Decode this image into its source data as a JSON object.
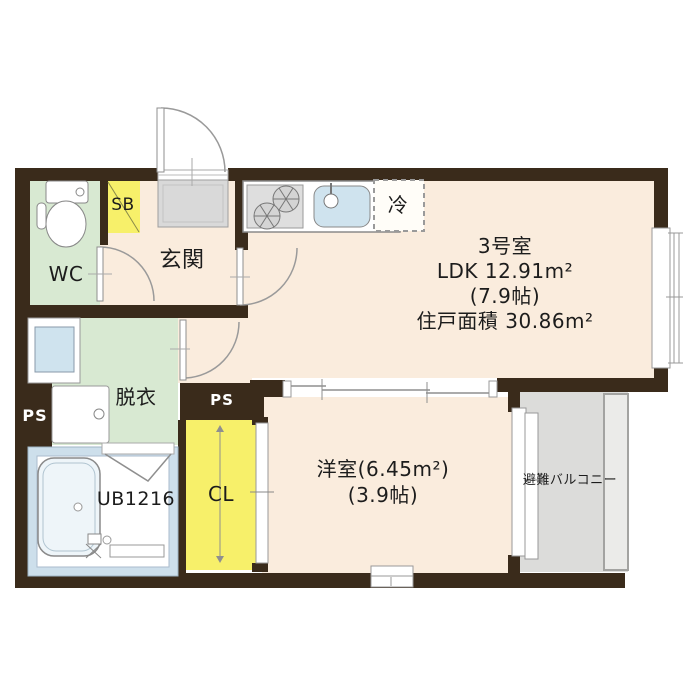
{
  "colors": {
    "wall": "#3a2b1b",
    "cream": "#faecdd",
    "green": "#d8e9d2",
    "yellow": "#f7f06a",
    "balcony_gray": "#dcdcda",
    "mat_gray": "#d9d9d9",
    "tile_blue": "#cddfeb",
    "fixture_blue": "#cfe3ee",
    "line": "#8f8f8f",
    "text": "#1c1c1c",
    "ps_text": "#ffffff"
  },
  "labels": {
    "wc": "WC",
    "sb": "SB",
    "genkan": "玄関",
    "fridge": "冷",
    "unit": "3号室",
    "ldk_area": "LDK 12.91m²",
    "ldk_tatami": "(7.9帖)",
    "total_area": "住戸面積 30.86m²",
    "datsui": "脱衣",
    "ps_left": "PS",
    "ps_mid": "PS",
    "bath": "UB1216",
    "closet": "CL",
    "yoshitsu_area": "洋室(6.45m²)",
    "yoshitsu_tatami": "(3.9帖)",
    "balcony": "避難バルコニー"
  }
}
